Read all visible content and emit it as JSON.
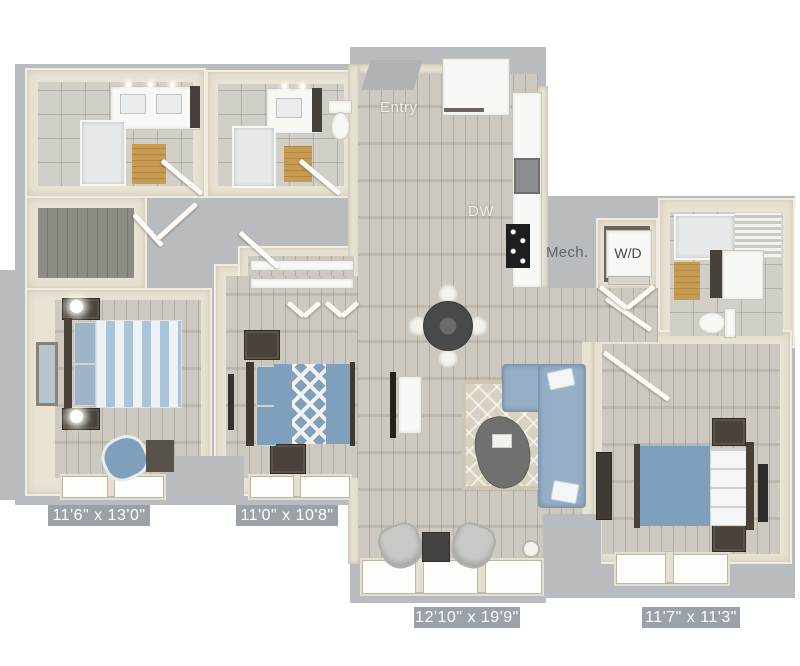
{
  "labels": {
    "entry": "Entry",
    "dishwasher": "DW",
    "mechanical": "Mech.",
    "washer_dryer": "W/D"
  },
  "room_dimensions": {
    "bedroom1": "11'6\" x 13'0\"",
    "bedroom2": "11'0\" x 10'8\"",
    "living": "12'10\" x 19'9\"",
    "bedroom3": "11'7\" x 11'3\""
  },
  "colors": {
    "slab": "#b9bcbe",
    "wood_floor": "#c8c3b9",
    "tile_floor": "#d2cfc9",
    "wood_mat": "#c79b52",
    "accent_blue": "#7fa0bd",
    "sofa_blue": "#95afc7",
    "rug": "#d8d1bf",
    "dimension_label_bg": "#9ba1a8",
    "dimension_label_text": "#ffffff"
  }
}
